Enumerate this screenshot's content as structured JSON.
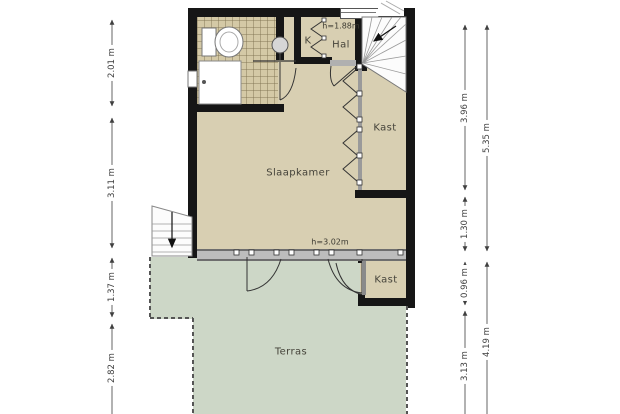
{
  "plan": {
    "title": "floor-plan",
    "rooms": {
      "slaapkamer": "Slaapkamer",
      "hal": "Hal",
      "k": "K",
      "kast_upper": "Kast",
      "kast_terras": "Kast",
      "terras": "Terras"
    },
    "heights": {
      "hal": "h=1.88m",
      "slaapkamer": "h=3.02m"
    },
    "dimensions": {
      "left": [
        "2.01 m",
        "3.11 m",
        "1.37 m",
        "2.82 m"
      ],
      "right_inner": [
        "3.96 m",
        "1.30 m",
        "0.96 m",
        "3.13 m"
      ],
      "right_outer": [
        "5.35 m",
        "4.19 m"
      ]
    },
    "colors": {
      "floor": "#d8cfb2",
      "bathroom_tile": "#d4c9a6",
      "terrace": "#cdd7c7",
      "wall": "#161616",
      "glass_facade": "#bdbdbd",
      "dimension": "#3f3f3f"
    }
  }
}
